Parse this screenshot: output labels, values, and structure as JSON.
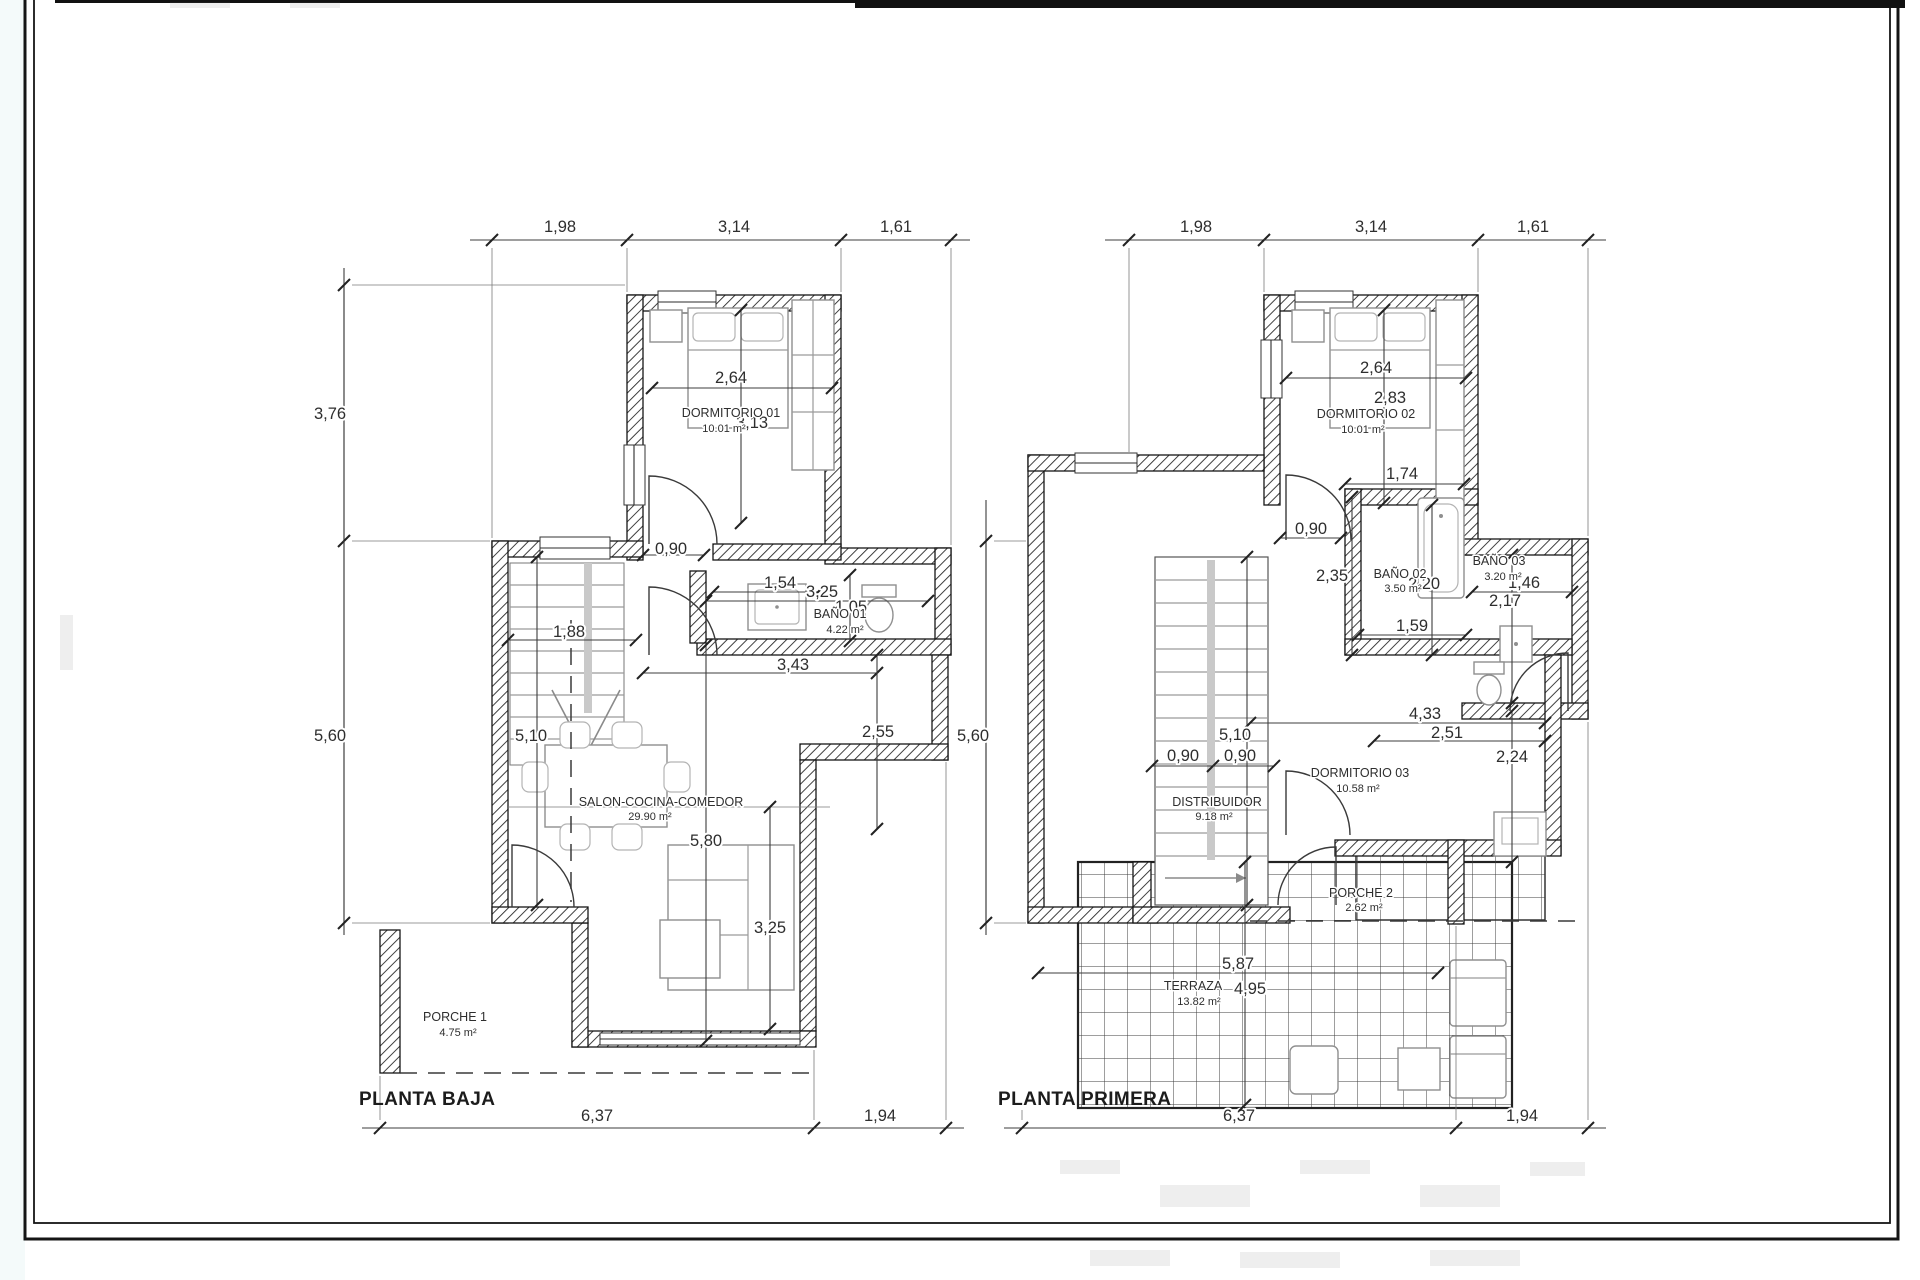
{
  "drawing": {
    "palette": {
      "ink": "#1a1a1a",
      "dim_ink": "#3c3c3c",
      "furniture_ink": "#8f8f8f",
      "paper": "#ffffff"
    },
    "plans": [
      {
        "id": "planta-baja",
        "title": "PLANTA BAJA",
        "rooms": [
          {
            "name": "DORMITORIO 01",
            "area": "10.01 m²"
          },
          {
            "name": "BAÑO 01",
            "area": "4.22 m²"
          },
          {
            "name": "SALON-COCINA-COMEDOR",
            "area": "29.90 m²"
          },
          {
            "name": "PORCHE 1",
            "area": "4.75 m²"
          }
        ],
        "dims": {
          "top": [
            "1,98",
            "3,14",
            "1,61"
          ],
          "side": [
            "3,76",
            "5,60"
          ],
          "bottom": [
            "6,37",
            "1,94"
          ],
          "interior": [
            "2,64",
            "3,13",
            "0,90",
            "1,54",
            "3,25",
            "1,05",
            "1,88",
            "3,43",
            "5,10",
            "2,55",
            "5,80",
            "3,25"
          ]
        }
      },
      {
        "id": "planta-primera",
        "title": "PLANTA PRIMERA",
        "rooms": [
          {
            "name": "DORMITORIO 02",
            "area": "10.01 m²"
          },
          {
            "name": "BAÑO 02",
            "area": "3.50 m²"
          },
          {
            "name": "BAÑO 03",
            "area": "3.20 m²"
          },
          {
            "name": "DORMITORIO 03",
            "area": "10.58 m²"
          },
          {
            "name": "DISTRIBUIDOR",
            "area": "9.18 m²"
          },
          {
            "name": "PORCHE 2",
            "area": "2.62 m²"
          },
          {
            "name": "TERRAZA",
            "area": "13.82 m²"
          }
        ],
        "dims": {
          "top": [
            "1,98",
            "3,14",
            "1,61"
          ],
          "side": [
            "5,60"
          ],
          "bottom": [
            "6,37",
            "1,94"
          ],
          "interior": [
            "2,64",
            "2,83",
            "1,74",
            "0,90",
            "2,35",
            "2,20",
            "1,46",
            "2,17",
            "1,59",
            "4,33",
            "2,51",
            "5,10",
            "0,90",
            "0,90",
            "2,24",
            "5,87",
            "4,95"
          ]
        }
      }
    ]
  }
}
